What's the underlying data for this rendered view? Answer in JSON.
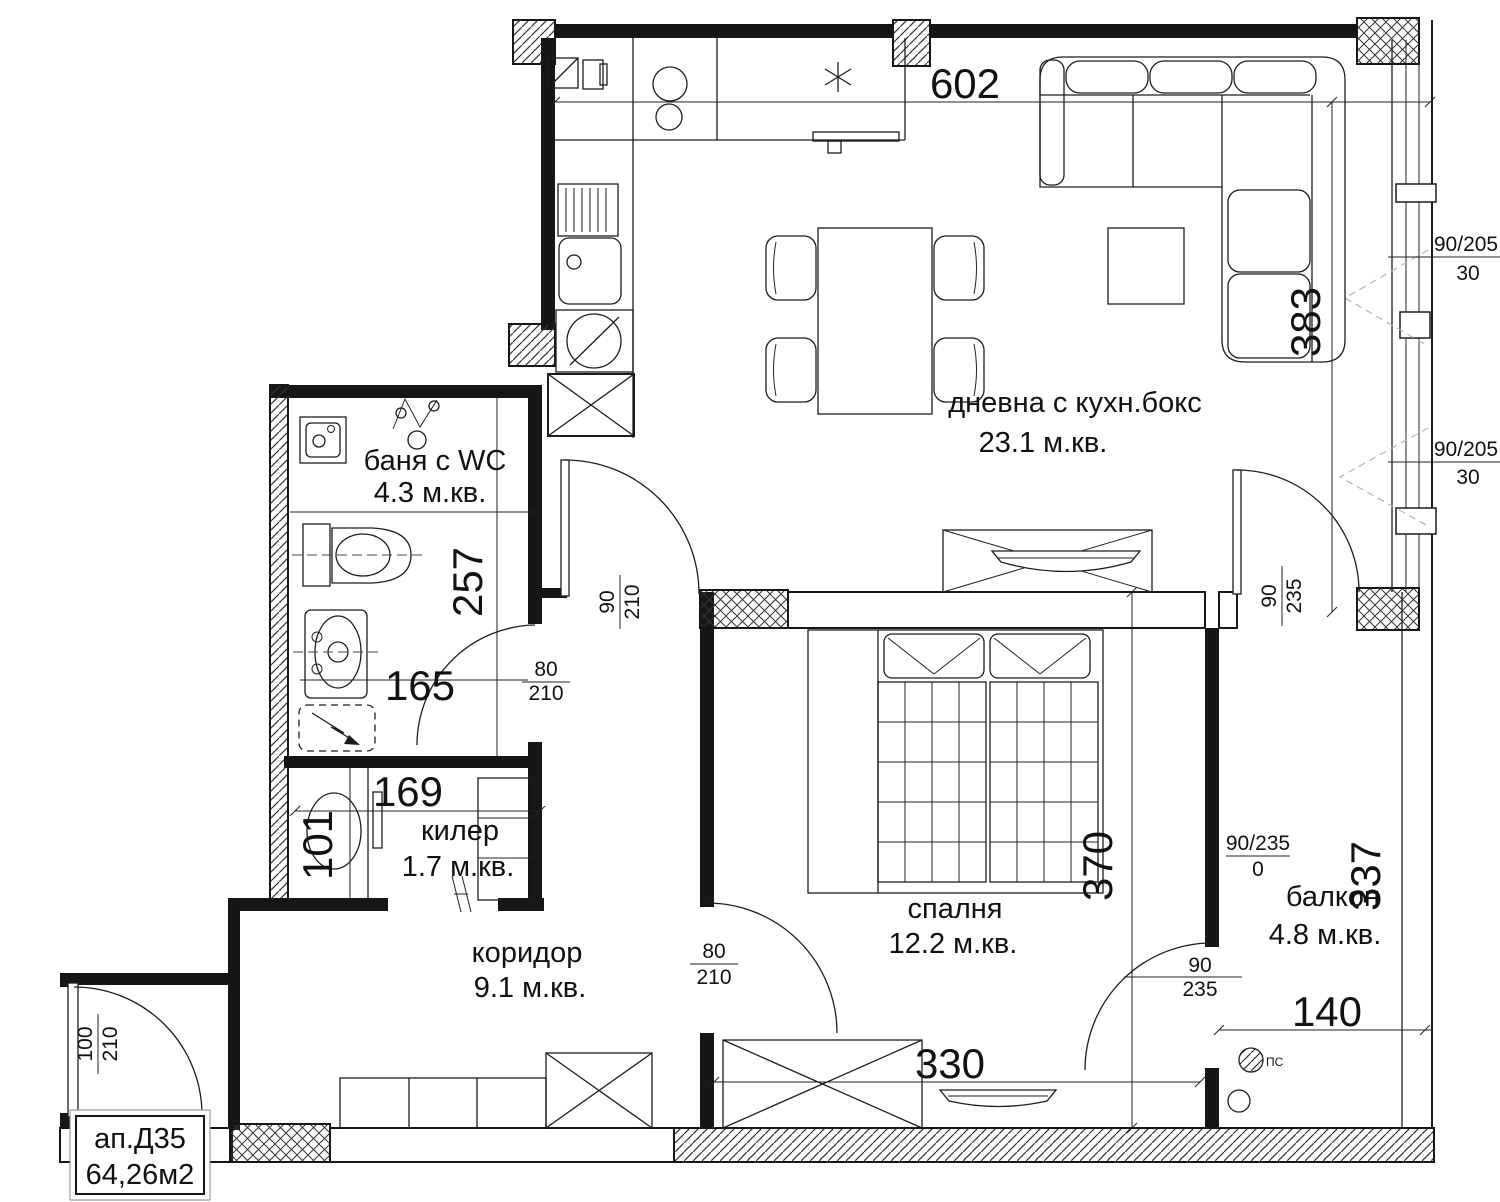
{
  "title_block": {
    "apartment": "ап.Д35",
    "area": "64,26м2"
  },
  "rooms": {
    "living": {
      "name": "дневна с кухн.бокс",
      "area": "23.1 м.кв."
    },
    "bath": {
      "name": "баня с WC",
      "area": "4.3 м.кв."
    },
    "closet": {
      "name": "килер",
      "area": "1.7 м.кв."
    },
    "corridor": {
      "name": "коридор",
      "area": "9.1 м.кв."
    },
    "bedroom": {
      "name": "спалня",
      "area": "12.2 м.кв."
    },
    "balcony": {
      "name": "балкон",
      "area": "4.8 м.кв."
    }
  },
  "dims": {
    "top_width": "602",
    "living_height": "383",
    "bath_height": "257",
    "bath_width": "165",
    "closet_width": "169",
    "closet_height": "101",
    "bedroom_height": "370",
    "balcony_height": "337",
    "balcony_width": "140",
    "bedroom_width": "330"
  },
  "doors": {
    "living": {
      "num": "90",
      "den": "210"
    },
    "bath": {
      "num": "80",
      "den": "210"
    },
    "bedroom": {
      "num": "80",
      "den": "210"
    },
    "entry": {
      "num": "100",
      "den": "210"
    },
    "living_balcony": {
      "num": "90",
      "den": "235"
    },
    "balcony_threshold": {
      "num": "90/235",
      "den": "0"
    },
    "bedroom_balcony": {
      "num": "90",
      "den": "235"
    }
  },
  "windows": {
    "top": {
      "size": "90/205",
      "sill": "30"
    },
    "mid": {
      "size": "90/205",
      "sill": "30"
    }
  },
  "annotations": {
    "ps": "ПС"
  }
}
